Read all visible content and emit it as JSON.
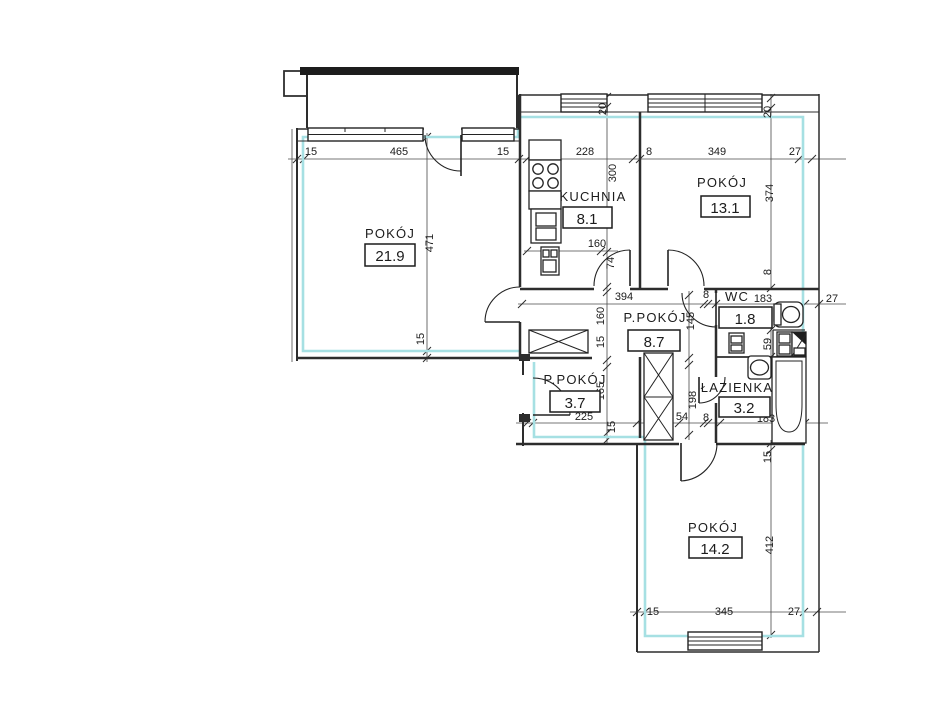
{
  "drawing": {
    "kind": "apartment-floor-plan",
    "colors": {
      "wall": "#2d2d2d",
      "inner_face_line": "#a6e0e3",
      "text": "#1c1c1c"
    },
    "rooms": [
      {
        "label": "POKÓJ",
        "area": "21.9"
      },
      {
        "label": "KUCHNIA",
        "area": "8.1"
      },
      {
        "label": "POKÓJ",
        "area": "13.1"
      },
      {
        "label": "P.POKÓJ",
        "area": "8.7"
      },
      {
        "label": "WC",
        "area": "1.8"
      },
      {
        "label": "ŁAZIENKA",
        "area": "3.2"
      },
      {
        "label": "P.POKÓJ",
        "area": "3.7"
      },
      {
        "label": "POKÓJ",
        "area": "14.2"
      }
    ],
    "dims": [
      "15",
      "465",
      "15",
      "228",
      "8",
      "349",
      "27",
      "20",
      "300",
      "20",
      "374",
      "471",
      "15",
      "74",
      "8",
      "145",
      "160",
      "15",
      "165",
      "15",
      "59",
      "198",
      "15",
      "412",
      "160",
      "394",
      "8",
      "183",
      "27",
      "225",
      "54",
      "8",
      "183",
      "15",
      "345",
      "27"
    ]
  }
}
